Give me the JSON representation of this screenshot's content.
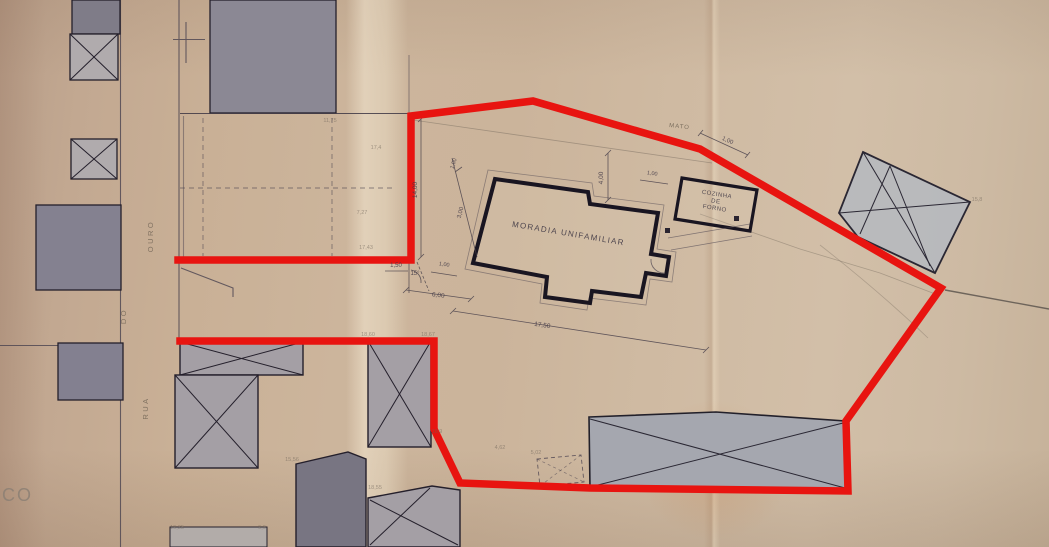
{
  "plan": {
    "main_building_label": "MORADIA UNIFAMILIAR",
    "outbuilding_label": {
      "line1": "COZINHA",
      "line2": "DE",
      "line3": "FORNO"
    },
    "street_name": {
      "word1": "RUA",
      "word2": "DO",
      "word3": "OURO"
    },
    "area_label": "MATO",
    "corner_partial_text": "CO",
    "dimensions": {
      "left_height": "14,00",
      "top_small": "1,00",
      "side_small": "3,00",
      "front_offset": "1,50",
      "angle": "15°",
      "front_small": "1,00",
      "front_width": "6,00",
      "building_length": "17,50",
      "right_height": "4,00",
      "right_small": "1,00",
      "boundary_small": "1,00"
    },
    "spot_levels": {
      "s1": "11,75",
      "s2": "17,4",
      "s3": "7,27",
      "s4": "17,43",
      "s5": "18,60",
      "s6": "18,67",
      "s7": "18,9",
      "s8": "18,55",
      "s9": "5,02",
      "s10": "4,62",
      "s11": "19,35",
      "s12": "15,56",
      "s13": "9,6",
      "s14": "15,8"
    },
    "colors": {
      "boundary_red": "#e81410",
      "paper": "#c9b29b",
      "ink": "#2b2530",
      "building_fill_dark": "#7f7c88",
      "building_fill_light": "#a49fa5"
    }
  }
}
